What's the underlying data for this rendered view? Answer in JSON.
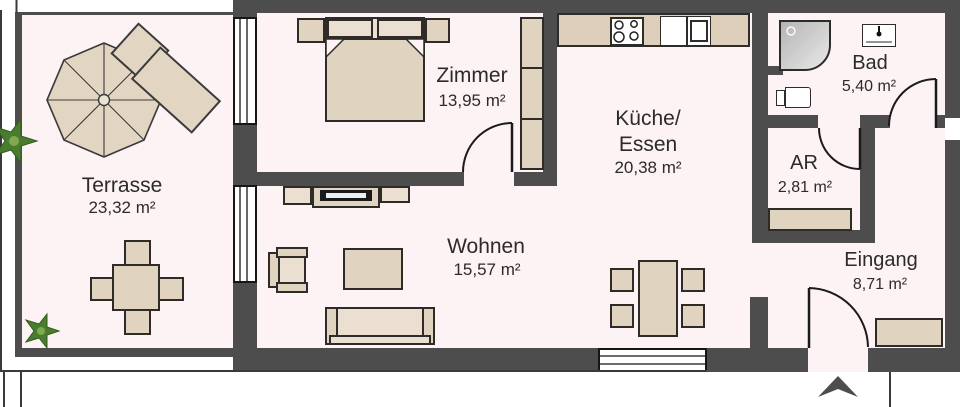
{
  "plan_title": "Apartment floor plan",
  "colors": {
    "wall": "#4d4d4d",
    "floor": "#fdf2f4",
    "furniture": "#e0d3bf",
    "furniture_light": "#eadfd0",
    "counter": "#ddcfb9",
    "outline": "#2e2b28",
    "text": "#2b2b2b",
    "plant": "#4a7c2f",
    "tv_screen": "#e8f0f4"
  },
  "rooms": [
    {
      "name": "Terrasse",
      "area": "23,32 m²"
    },
    {
      "name": "Zimmer",
      "area": "13,95 m²"
    },
    {
      "name": "Küche/",
      "name2": "Essen",
      "area": "20,38 m²"
    },
    {
      "name": "Bad",
      "area": "5,40 m²"
    },
    {
      "name": "AR",
      "area": "2,81 m²"
    },
    {
      "name": "Wohnen",
      "area": "15,57 m²"
    },
    {
      "name": "Eingang",
      "area": "8,71 m²"
    }
  ]
}
